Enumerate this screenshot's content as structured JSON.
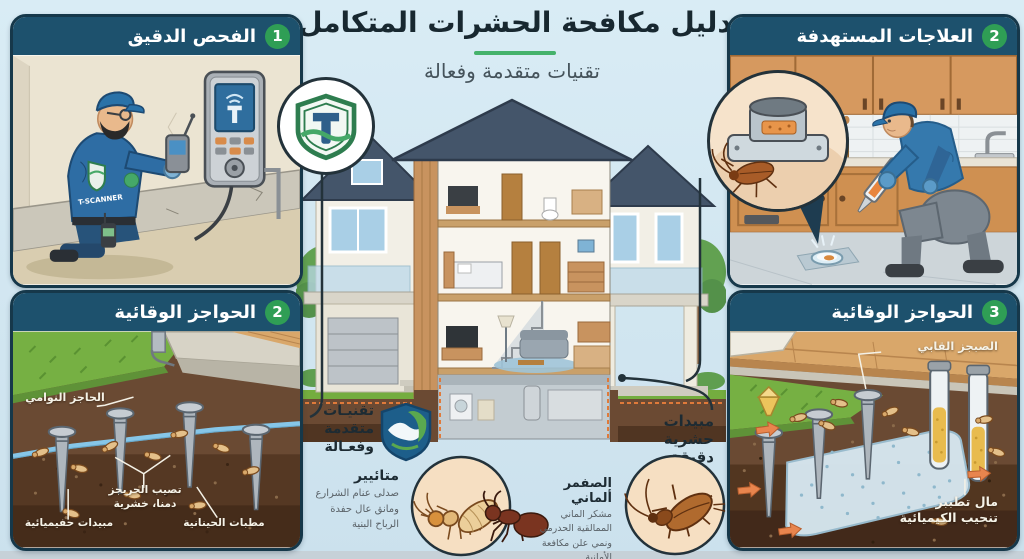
{
  "header": {
    "title": "دليل مكافحة الحشرات المتكامل",
    "subtitle": "تقنيات متقدمة وفعالة"
  },
  "panels": {
    "inspection": {
      "number": "1",
      "title": "الفحص الدقيق",
      "uniform_label": "T-SCANNER"
    },
    "treatments": {
      "number": "2",
      "title": "العلاجات المستهدفة"
    },
    "barriers_left": {
      "number": "2",
      "title": "الحواجز الوقائية",
      "labels": {
        "top": "الحاجز النوامي",
        "mid_line1": "تصيب الحريجز",
        "mid_line2": "دمنا، خشرية",
        "bottom_left": "مبيدات حفيميائية",
        "bottom_right": "مطبات الحينانية"
      }
    },
    "barriers_right": {
      "number": "3",
      "title": "الحواجز الوقائية",
      "labels": {
        "top": "الصبجز القابي",
        "bottom_line1": "مال تطببر",
        "bottom_line2": "تنحيب الكيميائية"
      }
    }
  },
  "center": {
    "tech_badge": {
      "line1": "تقنيـات",
      "line2": "متقدمة",
      "line3": "وفعـالة"
    },
    "insecticide_label": {
      "line1": "مبيدات",
      "line2": "حشرية دقيقة"
    },
    "termite_note": {
      "title": "متائيير",
      "line1": "صدلى عنام الشرارع",
      "line2": "ومانق عال حفدة",
      "line3": "الرباح البنية"
    },
    "cockroach_note": {
      "title": "الصفمر ألماني",
      "line1": "مشكر الماني",
      "line2": "الممالقية الحدرمي",
      "line3": "ونمي علن مكافعة",
      "line4": "الأمانية"
    }
  },
  "colors": {
    "accent_green": "#2f9e55",
    "header_navy": "#1d516d",
    "underline_green": "#45b26b",
    "background_blue": "#cfe3ee"
  }
}
